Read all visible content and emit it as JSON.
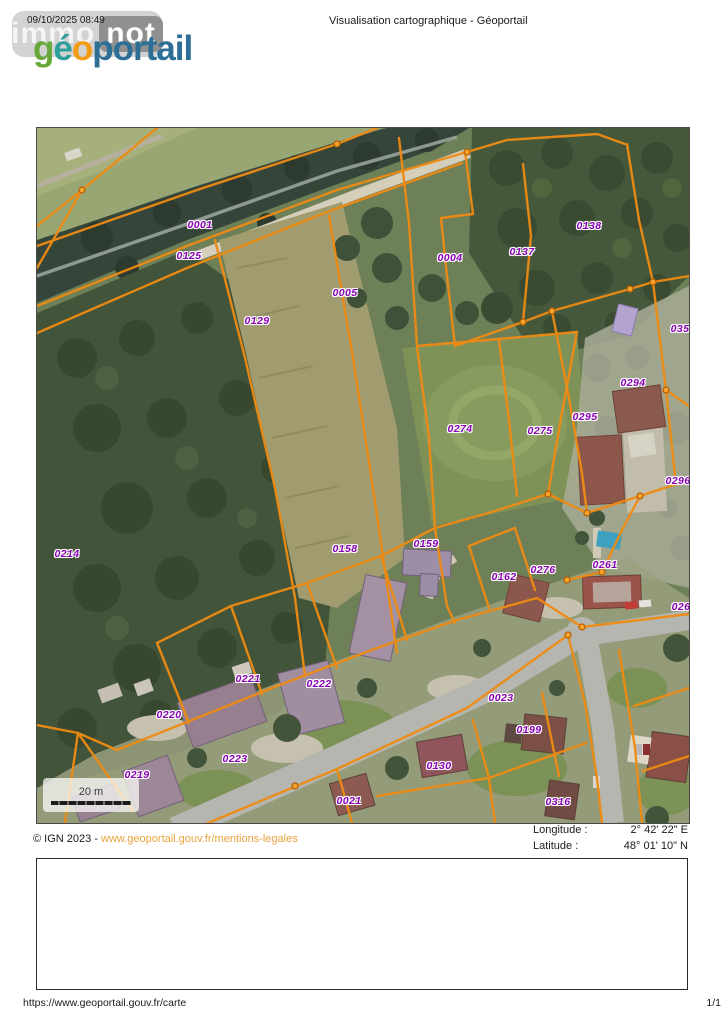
{
  "header": {
    "date": "09/10/2025 08:49",
    "title": "Visualisation cartographique - Géoportail",
    "watermark": {
      "part1": "immo",
      "part2": "not"
    },
    "logo": {
      "letters": [
        {
          "ch": "g",
          "color": "#67a83b"
        },
        {
          "ch": "é",
          "color": "#2f9f9a"
        },
        {
          "ch": "o",
          "color": "#f39c12"
        }
      ],
      "rest": "portail",
      "rest_color": "#2c6e96"
    }
  },
  "map": {
    "scale_label": "20 m",
    "parcel_label_color": "#8a00b5",
    "cadastre_line_color": "#ef8b12",
    "parcels": [
      {
        "id": "0001",
        "x": 163,
        "y": 97
      },
      {
        "id": "0125",
        "x": 152,
        "y": 128
      },
      {
        "id": "0005",
        "x": 308,
        "y": 165
      },
      {
        "id": "0129",
        "x": 220,
        "y": 193
      },
      {
        "id": "0004",
        "x": 413,
        "y": 130
      },
      {
        "id": "0137",
        "x": 485,
        "y": 124
      },
      {
        "id": "0138",
        "x": 552,
        "y": 98
      },
      {
        "id": "035",
        "x": 643,
        "y": 201
      },
      {
        "id": "0294",
        "x": 596,
        "y": 255
      },
      {
        "id": "0295",
        "x": 548,
        "y": 289
      },
      {
        "id": "0274",
        "x": 423,
        "y": 301
      },
      {
        "id": "0275",
        "x": 503,
        "y": 303
      },
      {
        "id": "0296",
        "x": 641,
        "y": 353
      },
      {
        "id": "0214",
        "x": 30,
        "y": 426
      },
      {
        "id": "0158",
        "x": 308,
        "y": 421
      },
      {
        "id": "0159",
        "x": 389,
        "y": 416
      },
      {
        "id": "0162",
        "x": 467,
        "y": 449
      },
      {
        "id": "0276",
        "x": 506,
        "y": 442
      },
      {
        "id": "0261",
        "x": 568,
        "y": 437
      },
      {
        "id": "026",
        "x": 644,
        "y": 479
      },
      {
        "id": "0221",
        "x": 211,
        "y": 551
      },
      {
        "id": "0222",
        "x": 282,
        "y": 556
      },
      {
        "id": "0220",
        "x": 132,
        "y": 587
      },
      {
        "id": "0223",
        "x": 198,
        "y": 631
      },
      {
        "id": "0219",
        "x": 100,
        "y": 647
      },
      {
        "id": "0023",
        "x": 464,
        "y": 570
      },
      {
        "id": "0199",
        "x": 492,
        "y": 602
      },
      {
        "id": "0130",
        "x": 402,
        "y": 638
      },
      {
        "id": "0316",
        "x": 521,
        "y": 674
      },
      {
        "id": "0021",
        "x": 312,
        "y": 673
      }
    ]
  },
  "footer": {
    "copyright": "© IGN 2023 - ",
    "link": "www.geoportail.gouv.fr/mentions-legales",
    "link_color": "#e8a33d",
    "longitude_label": "Longitude :",
    "longitude_value": "2° 42' 22\" E",
    "latitude_label": "Latitude :",
    "latitude_value": "48° 01' 10\" N",
    "url": "https://www.geoportail.gouv.fr/carte",
    "page": "1/1"
  }
}
